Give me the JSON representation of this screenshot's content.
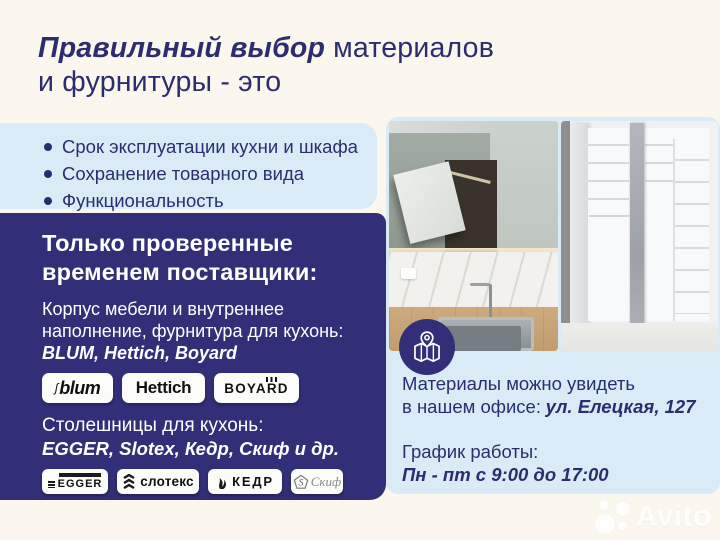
{
  "colors": {
    "background": "#FBF7EE",
    "panel_blue": "#D9EBF6",
    "navy": "#322F78",
    "text_navy": "#2C2D6E",
    "badge_white": "#FCFCFA"
  },
  "header": {
    "title_emphasis": "Правильный выбор",
    "title_tail": "материалов",
    "title_line2": "и фурнитуры - это"
  },
  "benefits": {
    "items": [
      "Срок эксплуатации кухни и шкафа",
      "Сохранение товарного вида",
      "Функциональность"
    ]
  },
  "suppliers": {
    "heading_line1": "Только проверенные",
    "heading_line2": "временем поставщики:",
    "intro_line1": "Корпус мебели и внутреннее",
    "intro_line2": "наполнение, фурнитура для кухонь:",
    "intro_brands": "BLUM, Hettich, Boyard",
    "badge_blum": "blum",
    "badge_hettich": "Hettich",
    "badge_boyard": "BOYARD",
    "countertops_label": "Столешницы для кухонь:",
    "countertops_brands": "EGGER, Slotex, Кедр, Скиф и др.",
    "badge_egger": "EGGER",
    "badge_slotex": "слотекс",
    "badge_kedr": "КЕДР",
    "badge_skif": "Скиф"
  },
  "office": {
    "line1": "Материалы можно увидеть",
    "line2_prefix": "в нашем офисе:",
    "address": "ул. Елецкая, 127",
    "schedule_label": "График работы:",
    "schedule_value": "Пн - пт с 9:00 до 17:00"
  },
  "watermark": {
    "brand": "Avito"
  }
}
